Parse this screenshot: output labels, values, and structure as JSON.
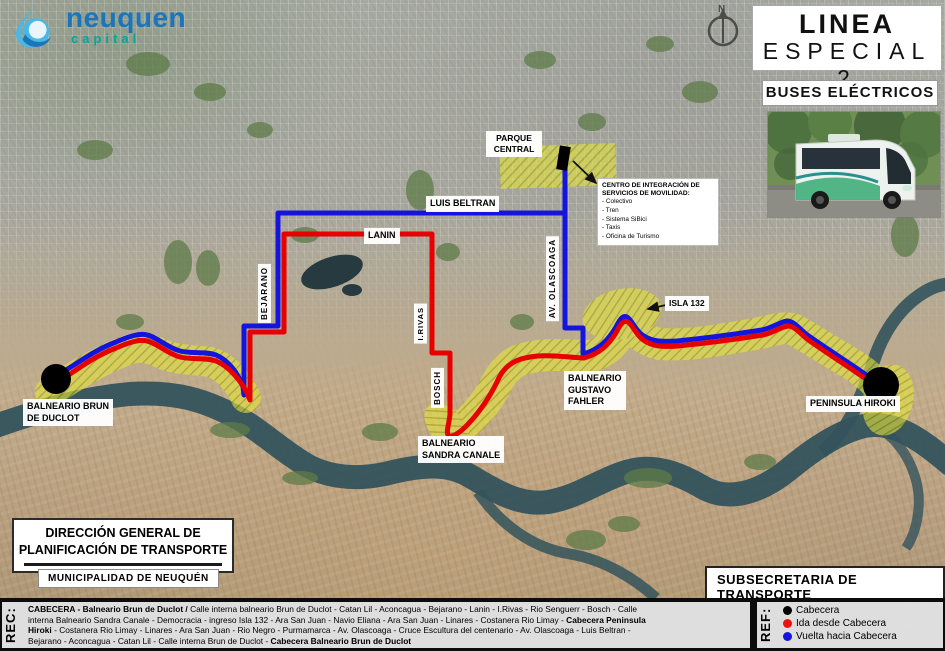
{
  "header": {
    "logo_name": "neuquen",
    "logo_tagline": "capital",
    "title_line1": "LINEA",
    "title_line2": "ESPECIAL 2",
    "subtitle": "BUSES ELÉCTRICOS",
    "compass_n": "N"
  },
  "map": {
    "labels": {
      "parque_central": "PARQUE\nCENTRAL",
      "luis_beltran": "LUIS BELTRAN",
      "lanin": "LANIN",
      "bejarano": "BEJARANO",
      "rivas": "I.RIVAS",
      "bosch": "BOSCH",
      "olascoaga": "AV. OLASCOAGA",
      "isla_132": "ISLA 132",
      "balneario_fahler": "BALNEARIO\nGUSTAVO\nFAHLER",
      "balneario_sandra": "BALNEARIO\nSANDRA CANALE",
      "balneario_brun": "BALNEARIO BRUN\nDE DUCLOT",
      "peninsula_hiroki": "PENINSULA HIROKI"
    },
    "centro_integracion": {
      "title": "CENTRO DE INTEGRACIÓN DE SERVICIOS DE MOVILIDAD:",
      "items": [
        "- Colectivo",
        "- Tren",
        "- Sistema SiBici",
        "- Taxis",
        "- Oficina de Turismo"
      ]
    }
  },
  "footer": {
    "direccion_line1": "DIRECCIÓN GENERAL DE",
    "direccion_line2": "PLANIFICACIÓN DE TRANSPORTE",
    "municipalidad": "MUNICIPALIDAD DE NEUQUÉN",
    "subsecretaria": "SUBSECRETARIA DE TRANSPORTE"
  },
  "bottom_bar": {
    "rec_label": "REC:",
    "ref_label": "REF:",
    "rec_lines": [
      [
        {
          "t": "CABECERA - Balneario Brun de Duclot / ",
          "b": true
        },
        {
          "t": "Calle interna balneario Brun de Duclot - Catan Lil - Aconcagua - Bejarano - Lanin - I.Rivas - Rio Senguerr - Bosch - Calle",
          "b": false
        }
      ],
      [
        {
          "t": "interna Balneario Sandra Canale - Democracia - ingreso Isla 132 - Ara San Juan - Navio Eliana - Ara San Juan - Linares - Costanera Rio Limay - ",
          "b": false
        },
        {
          "t": "Cabecera Peninsula",
          "b": true
        }
      ],
      [
        {
          "t": "Hiroki",
          "b": true
        },
        {
          "t": " - Costanera Rio Limay - Linares - Ara San Juan - Rio Negro - Purmamarca - Av. Olascoaga - Cruce Escultura del centenario - Av. Olascoaga - Luis Beltran -",
          "b": false
        }
      ],
      [
        {
          "t": "Bejarano - Aconcagua - Catan Lil - Calle interna Brun de Duclot - ",
          "b": false
        },
        {
          "t": "Cabecera Balneario Brun de Duclot",
          "b": true
        }
      ]
    ],
    "legend": [
      {
        "label": "Cabecera",
        "color": "#000000"
      },
      {
        "label": "Ida desde Cabecera",
        "color": "#ee1111"
      },
      {
        "label": "Vuelta hacia Cabecera",
        "color": "#1414e0"
      }
    ]
  },
  "watermark": {
    "line1": "Acti",
    "line2": "Ve a"
  },
  "colors": {
    "route_ida": "#e60000",
    "route_vuelta": "#1414dd",
    "corridor_bg": "#e4e43c",
    "corridor_hatch": "#a3a316",
    "cabecera_dot": "#000000",
    "river": "#34535c"
  }
}
